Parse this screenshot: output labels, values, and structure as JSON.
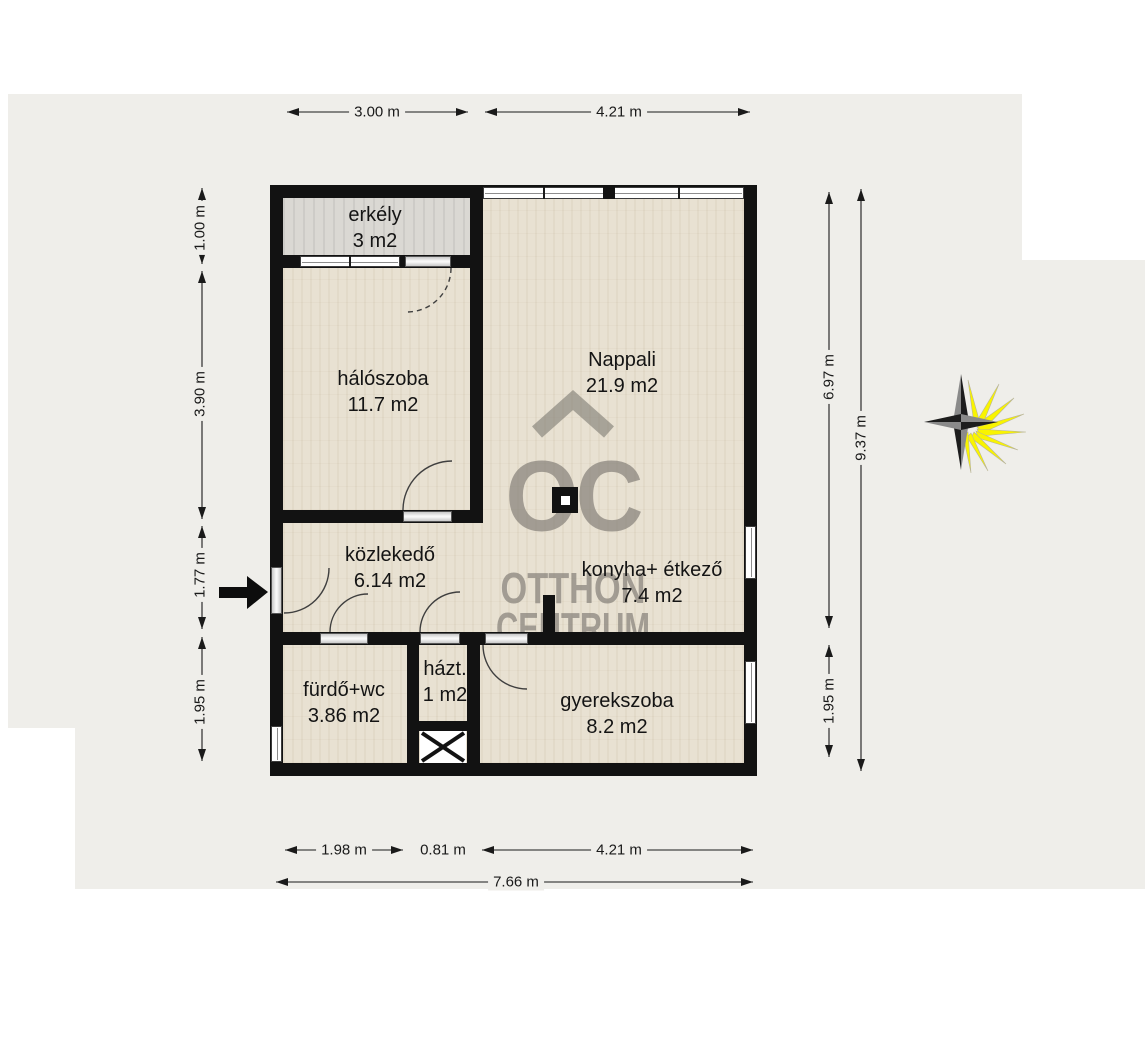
{
  "plan": {
    "rooms": [
      {
        "name": "erkély",
        "area": "3 m2"
      },
      {
        "name": "hálószoba",
        "area": "11.7 m2"
      },
      {
        "name": "Nappali",
        "area": "21.9 m2"
      },
      {
        "name": "közlekedő",
        "area": "6.14 m2"
      },
      {
        "name": "konyha+ étkező",
        "area": "7.4 m2"
      },
      {
        "name": "fürdő+wc",
        "area": "3.86 m2"
      },
      {
        "name": "házt.",
        "area": "1 m2"
      },
      {
        "name": "gyerekszoba",
        "area": "8.2 m2"
      }
    ],
    "dimensions": {
      "top": [
        "3.00 m",
        "4.21 m"
      ],
      "left": [
        "1.00 m",
        "3.90 m",
        "1.77 m",
        "1.95 m"
      ],
      "right_inner": [
        "6.97 m",
        "1.95 m"
      ],
      "right_outer": "9.37 m",
      "bottom": [
        "1.98 m",
        "0.81 m",
        "4.21 m"
      ],
      "bottom_total": "7.66 m"
    },
    "watermark": {
      "initials": "OC",
      "line1": "OTTHON",
      "line2": "CENTRUM"
    },
    "icons": {
      "compass": "compass-rose",
      "entrance": "entrance-arrow",
      "shaft": "shaft-x-box",
      "column": "structural-column"
    },
    "colors": {
      "backdrop": "#efeeea",
      "wall": "#121212",
      "floor": "#e8e1d2",
      "balcony_floor": "#dad8d3",
      "watermark": "#807c75",
      "compass_yellow": "#f9f400"
    }
  }
}
